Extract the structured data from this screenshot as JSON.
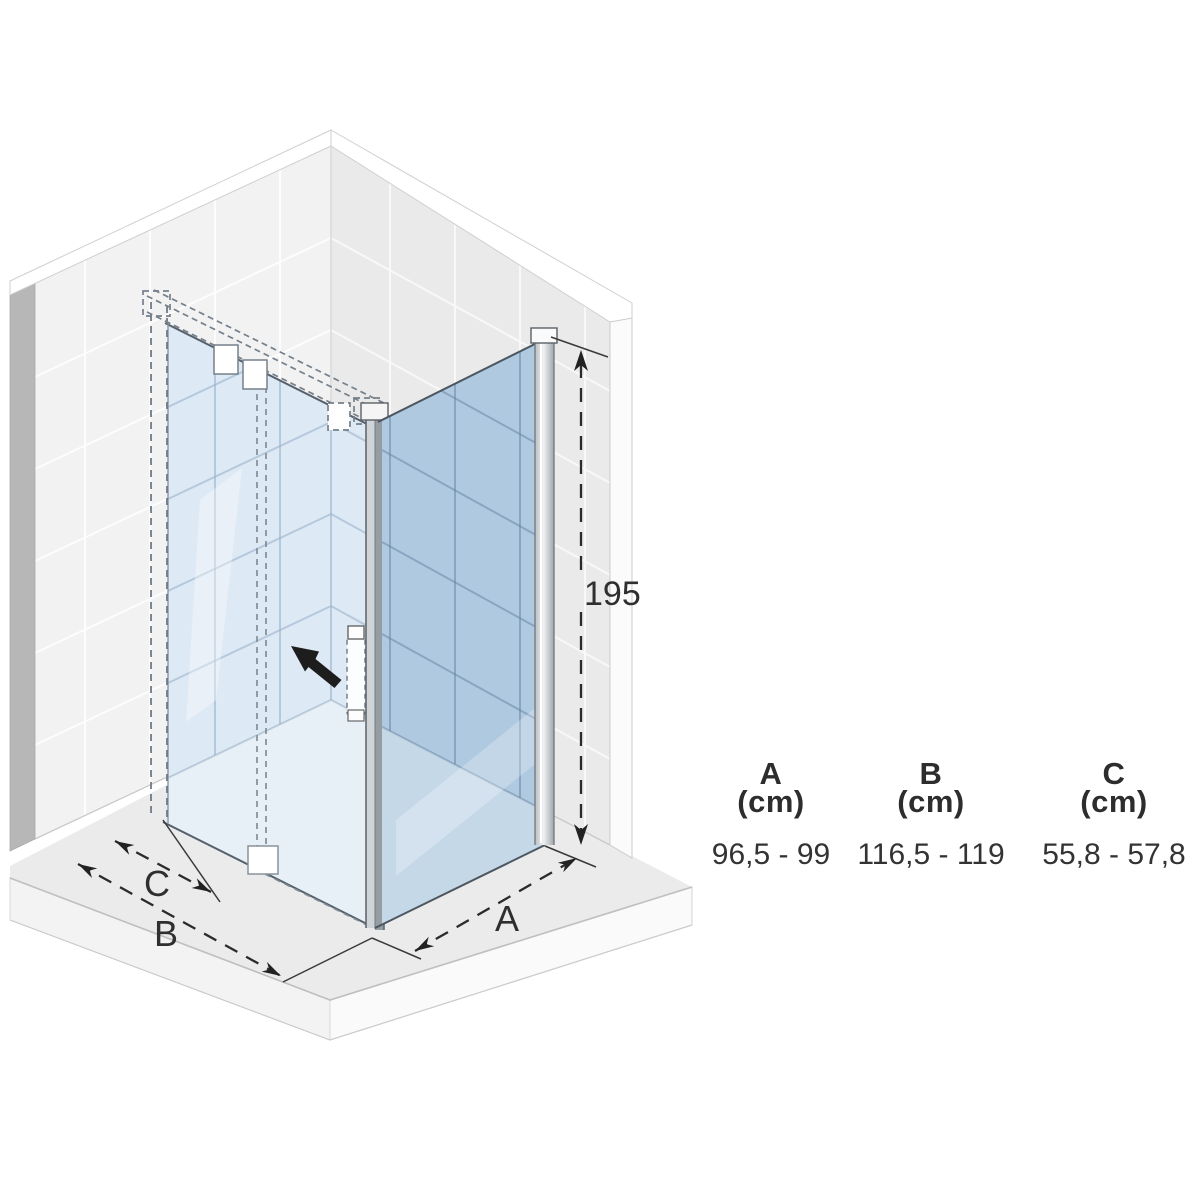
{
  "diagram": {
    "height_label": "195",
    "dim_a_label": "A",
    "dim_b_label": "B",
    "dim_c_label": "C",
    "icons": [
      "slide-direction-arrow"
    ],
    "colors": {
      "glass_light": "#dde9f4",
      "glass_dark": "#afc9e0",
      "wall_left": "#f2f2f2",
      "wall_right": "#eaeaea",
      "wall_edge": "#b7b7b7",
      "floor": "#ebebeb",
      "dimension_line": "#2b2b2b"
    }
  },
  "table": {
    "columns": [
      {
        "label": "A",
        "unit": "(cm)",
        "range": "96,5 - 99"
      },
      {
        "label": "B",
        "unit": "(cm)",
        "range": "116,5 - 119"
      },
      {
        "label": "C",
        "unit": "(cm)",
        "range": "55,8 - 57,8"
      }
    ]
  }
}
